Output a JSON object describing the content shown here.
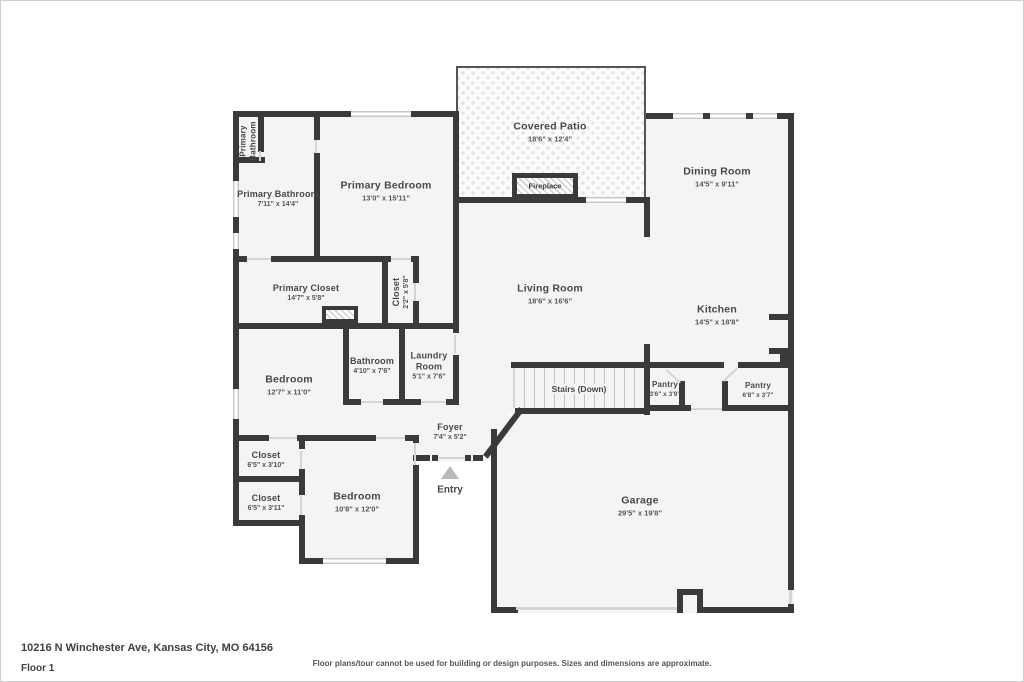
{
  "colors": {
    "wall": "#3a3a3a",
    "room_fill": "#f4f4f4",
    "window": "#c9c9c9",
    "label_text": "#474747",
    "entry_arrow": "#b9b9b9"
  },
  "rooms": [
    {
      "name": "Primary Bathroom"
    },
    {
      "name": "Primary Bathroom",
      "dims": "7'11\" x 14'4\""
    },
    {
      "name": "Primary Bedroom",
      "dims": "13'0\" x 15'11\""
    },
    {
      "name": "Covered Patio",
      "dims": "18'6\" x 12'4\""
    },
    {
      "name": "Fireplace"
    },
    {
      "name": "Dining Room",
      "dims": "14'5\" x 9'11\""
    },
    {
      "name": "Primary Closet",
      "dims": "14'7\" x 5'8\""
    },
    {
      "name": "Closet",
      "dims": "2'2\" x 5'8\""
    },
    {
      "name": "Living Room",
      "dims": "18'6\" x 16'6\""
    },
    {
      "name": "Kitchen",
      "dims": "14'5\" x 18'8\""
    },
    {
      "name": "Bedroom",
      "dims": "12'7\" x 11'0\""
    },
    {
      "name": "Bathroom",
      "dims": "4'10\" x 7'6\""
    },
    {
      "name": "Laundry Room",
      "dims": "5'1\" x 7'6\""
    },
    {
      "name": "Stairs (Down)"
    },
    {
      "name": "Pantry",
      "dims": "3'6\" x 3'9\""
    },
    {
      "name": "Pantry",
      "dims": "6'8\" x 3'7\""
    },
    {
      "name": "Foyer",
      "dims": "7'4\" x 5'2\""
    },
    {
      "name": "Closet",
      "dims": "6'5\" x 3'10\""
    },
    {
      "name": "Closet",
      "dims": "6'5\" x 3'11\""
    },
    {
      "name": "Bedroom",
      "dims": "10'8\" x 12'0\""
    },
    {
      "name": "Entry"
    },
    {
      "name": "Garage",
      "dims": "29'5\" x 19'8\""
    }
  ],
  "footer": {
    "address": "10216 N Winchester Ave, Kansas City, MO 64156",
    "floor_label": "Floor 1",
    "disclaimer": "Floor plans/tour cannot be used for building or design purposes. Sizes and dimensions are approximate."
  }
}
